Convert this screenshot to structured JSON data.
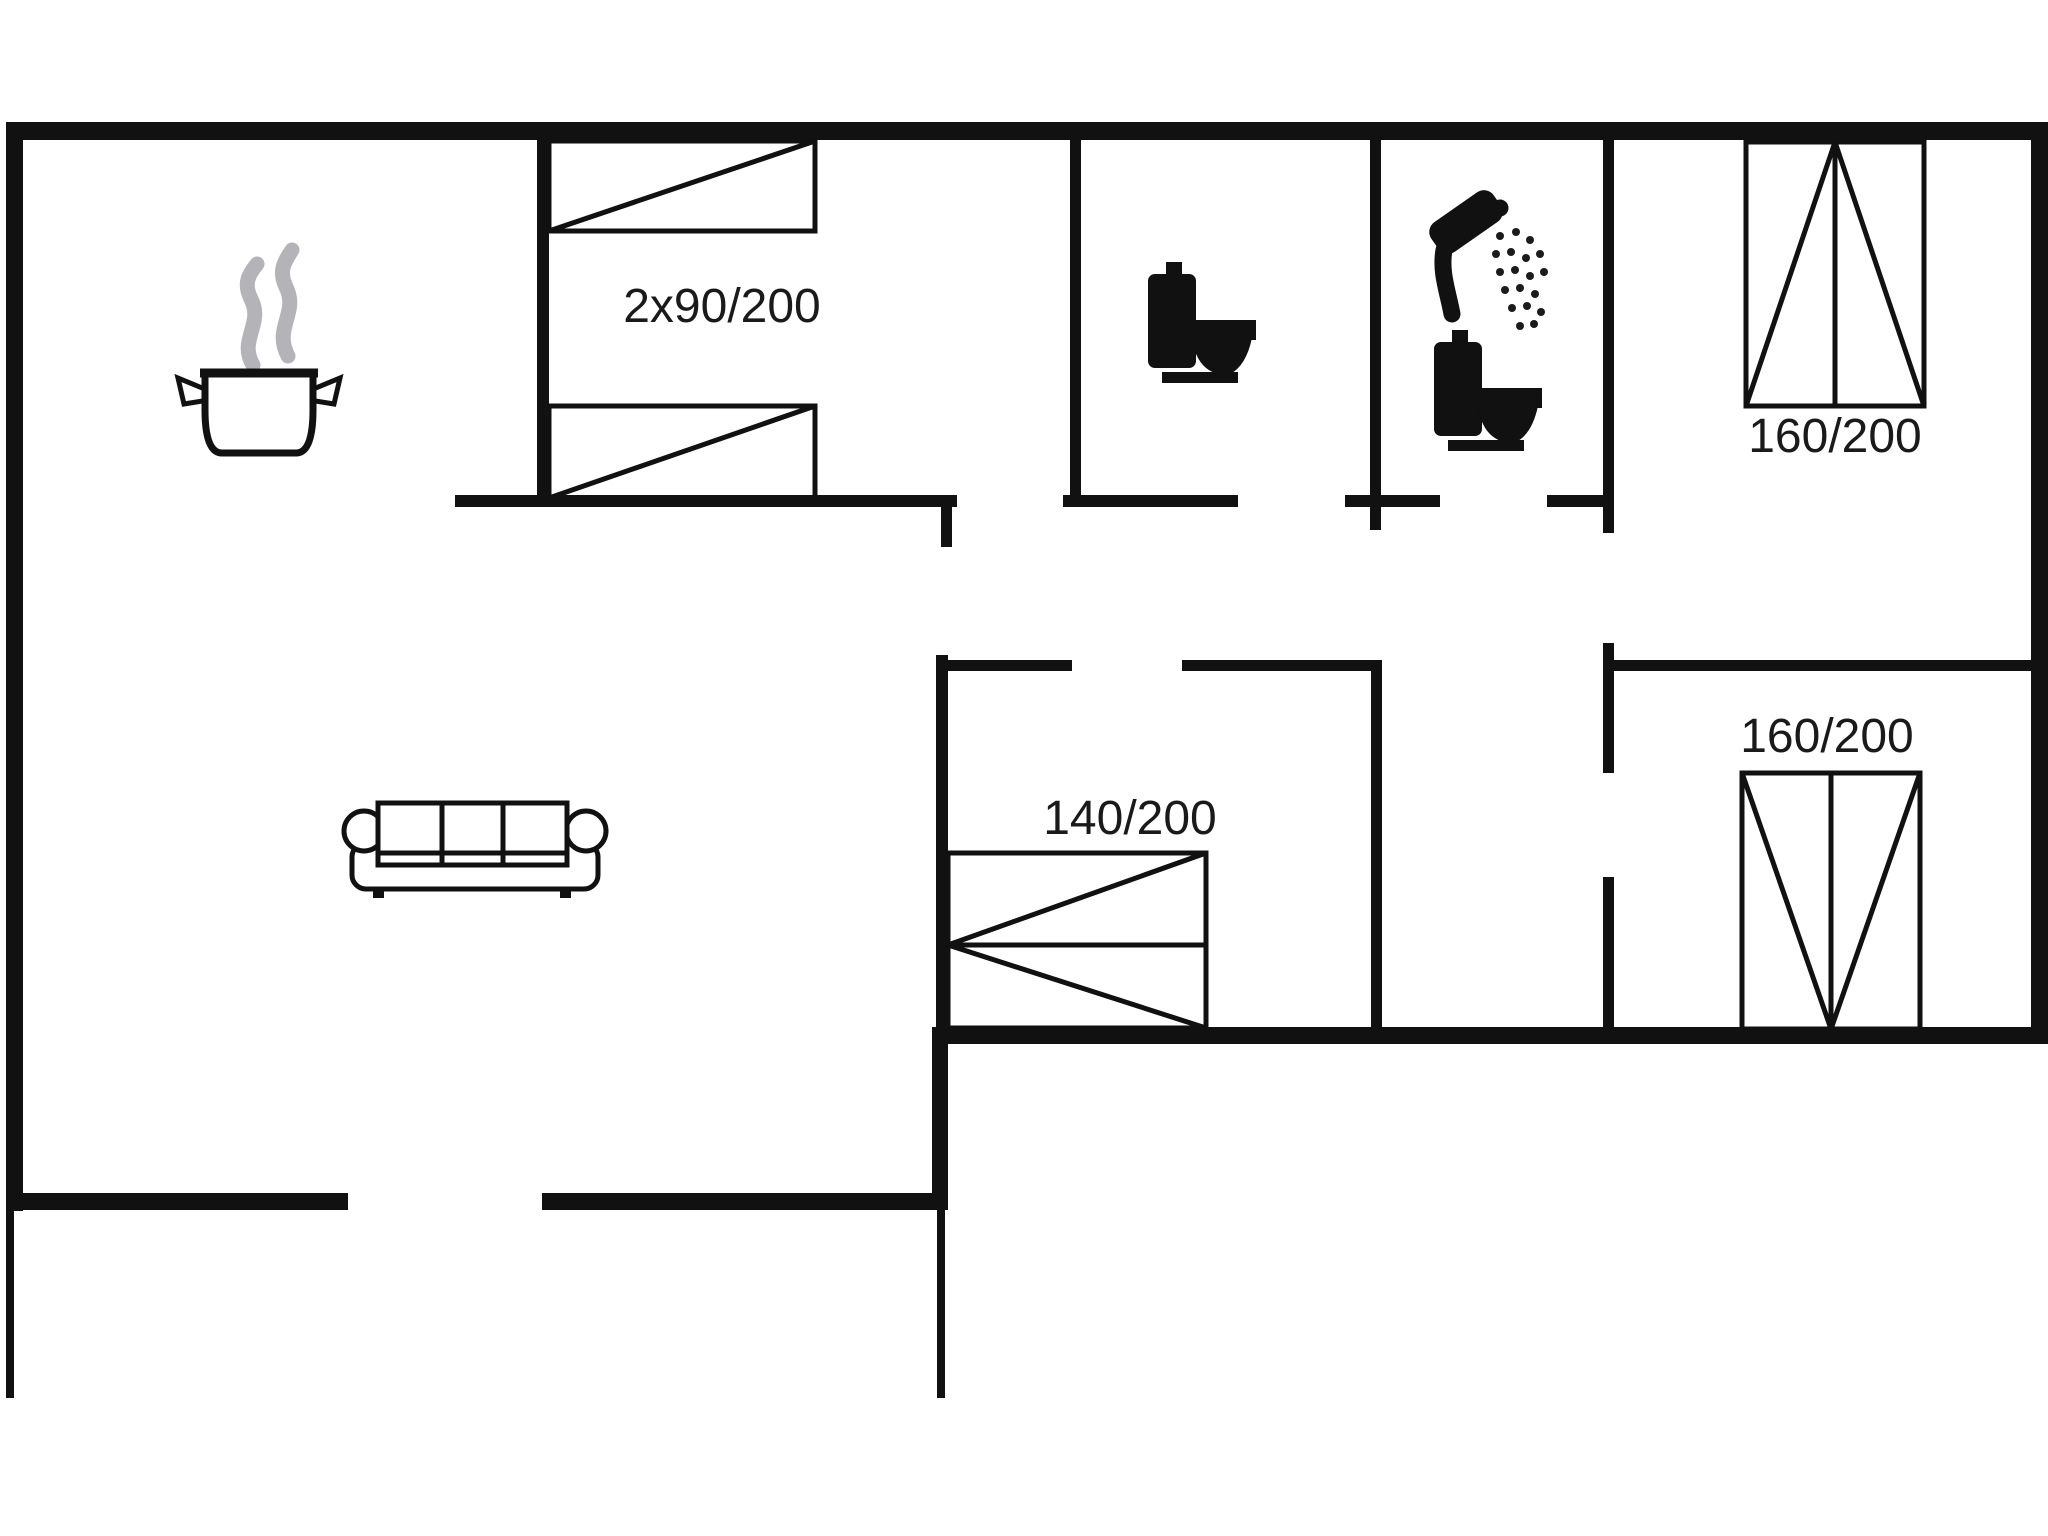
{
  "diagram": {
    "type": "floor-plan",
    "colors": {
      "background": "#ffffff",
      "walls": "#111111",
      "furniture_outline": "#111111",
      "steam": "#b4b4b8",
      "label_text": "#1a1a1a"
    },
    "rooms": {
      "bedroom_top_left": {
        "bed_label": "2x90/200"
      },
      "bedroom_top_right": {
        "bed_label": "160/200"
      },
      "bedroom_mid_right": {
        "bed_label": "160/200"
      },
      "bedroom_center": {
        "bed_label": "140/200"
      }
    },
    "fixtures": {
      "kitchen": "cooking-pot-icon",
      "wc_room": "toilet-icon",
      "bathroom": [
        "shower-icon",
        "toilet-icon"
      ],
      "living_room": "sofa-icon"
    }
  }
}
